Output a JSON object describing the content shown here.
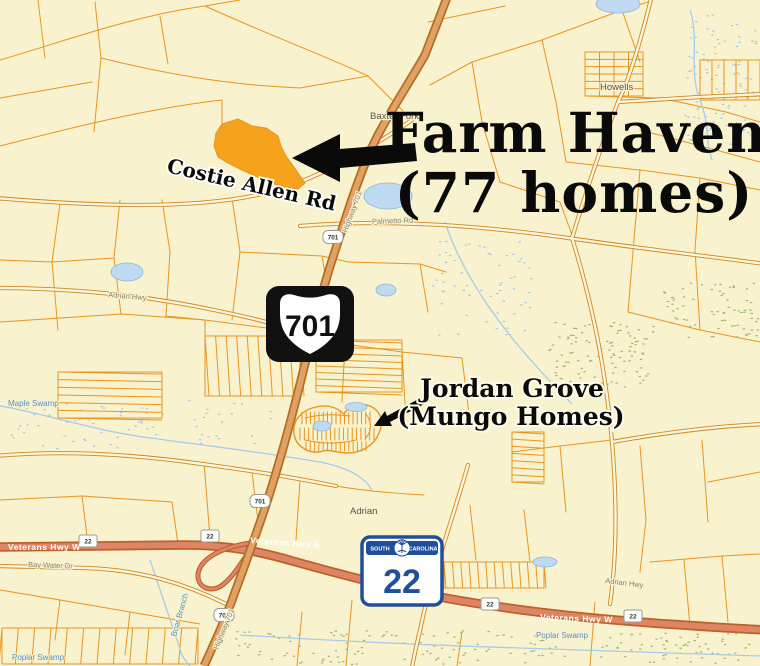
{
  "annotations": {
    "farm_haven_line1": "Farm Haven",
    "farm_haven_line2": "(77 homes)",
    "costie_allen_rd": "Costie Allen Rd",
    "jordan_grove_line1": "Jordan Grove",
    "jordan_grove_line2": "(Mungo Homes)"
  },
  "shields": {
    "us_route_number": "701",
    "sc_route_number": "22",
    "sc_state_left": "SOUTH",
    "sc_state_right": "CAROLINA"
  },
  "route_markers": {
    "m701": "701",
    "m22": "22"
  },
  "place_labels": {
    "baxter_fork": "Baxter Fork",
    "howells": "Howells",
    "adrian": "Adrian"
  },
  "road_labels": {
    "veterans_hwy_e": "Veterans Hwy E",
    "veterans_hwy_w": "Veterans Hwy W",
    "bay_water_dr": "Bay Water Dr",
    "adrian_hwy": "Adrian Hwy",
    "palmetto_rd": "Palmetto Rd",
    "highway_701": "Highway 701"
  },
  "water_labels": {
    "maple_swamp": "Maple Swamp",
    "poplar_swamp": "Poplar Swamp",
    "boar_branch": "Boar Branch"
  },
  "colors": {
    "bg": "#F8F3CE",
    "parcel": "#E8951F",
    "highlight": "#F5A31C",
    "water": "#BFDAF0",
    "hwy701": "#E0A066",
    "hwy22": "#DE8566",
    "scblue": "#1F4E9C",
    "waterlabel": "#5B8FC9"
  }
}
